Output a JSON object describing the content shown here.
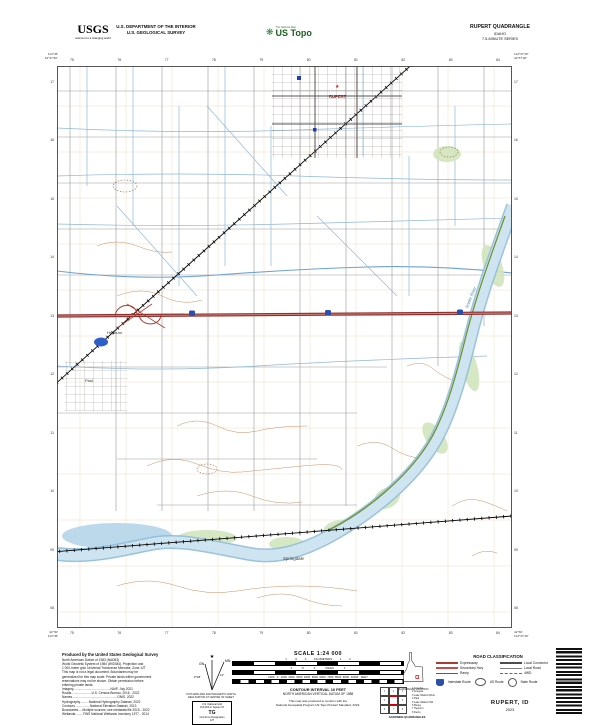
{
  "header": {
    "usgs_logo": "USGS",
    "usgs_tagline": "science for a changing world",
    "dept_line1": "U.S. DEPARTMENT OF THE INTERIOR",
    "dept_line2": "U.S. GEOLOGICAL SURVEY",
    "ustopo_glyph": "❋",
    "ustopo_small": "The National Map",
    "ustopo_name": "US Topo",
    "quad_title": "RUPERT QUADRANGLE",
    "quad_state": "IDAHO",
    "quad_series": "7.5-MINUTE SERIES"
  },
  "collar": {
    "top_ticks": [
      "75",
      "76",
      "77",
      "78",
      "79",
      "80",
      "81",
      "82",
      "83",
      "84"
    ],
    "bottom_ticks": [
      "75",
      "76",
      "77",
      "78",
      "79",
      "80",
      "81",
      "82",
      "83",
      "84"
    ],
    "left_ticks": [
      "17",
      "16",
      "15",
      "14",
      "13",
      "12",
      "11",
      "10",
      "09",
      "08"
    ],
    "right_ticks": [
      "17",
      "16",
      "15",
      "14",
      "13",
      "12",
      "11",
      "10",
      "09",
      "08"
    ],
    "tl_lon": "113°45'",
    "tl_lat": "42°37'30\"",
    "tr_lon": "113°37'30\"",
    "tr_lat": "42°37'30\"",
    "bl_lon": "113°45'",
    "bl_lat": "42°30'",
    "br_lon": "113°37'30\"",
    "br_lat": "42°30'"
  },
  "map_labels": {
    "city": "RUPERT",
    "city_star_icon": "★",
    "heyburn": "Heyburn",
    "paul": "Paul",
    "springdale": "Springdale",
    "river": "Snake River"
  },
  "footer": {
    "produced_by": "Produced by the United States Geological Survey",
    "credits": [
      "North American Datum of 1983 (NAD83)",
      "World Geodetic System of 1984 (WGS84). Projection and",
      "1 000-meter grid: Universal Transverse Mercator, Zone 12T",
      "This map is not a legal document. Boundaries may be",
      "generalized for this map scale. Private lands within government",
      "reservations may not be shown. Obtain permission before",
      "entering private lands.",
      "Imagery..........................................NAIP, July 2021",
      "Roads.......................U.S. Census Bureau, 2016 - 2022",
      "Names...................................................GNIS, 2022",
      "Hydrography..........National Hydrography Dataset, 2022",
      "Contours.................National Elevation Dataset, 2013",
      "Boundaries.....Multiple sources; see metadata file 2015 - 2022",
      "Wetlands.........FWS National Wetlands Inventory 1977 - 2014"
    ],
    "declination": {
      "star": "★",
      "gn_label": "GN",
      "mn_label": "MN",
      "gn_angle": "0°18'",
      "mn_angle": "11°",
      "caption1": "UTM GRID AND 2023 MAGNETIC NORTH",
      "caption2": "DECLINATION AT CENTER OF SHEET"
    },
    "usng": {
      "title": "U.S. National Grid",
      "sub": "100,000-m Square ID",
      "square": "TG",
      "gzd_label": "Grid Zone Designation",
      "gzd": "12T"
    },
    "scale": {
      "title": "SCALE 1:24 000",
      "km_row": "1          .5          0          KILOMETERS          1          2",
      "mi_row": "1            .5             0             MILES             1",
      "ft_row": "1000   0   1000  2000  3000  4000  5000  6000  7000  8000  9000  10000   FEET",
      "contour1": "CONTOUR INTERVAL 10 FEET",
      "contour2": "NORTH AMERICAN VERTICAL DATUM OF 1988",
      "conform1": "This map was produced to conform with the",
      "conform2": "National Geospatial Program US Topo Product Standard, 2023."
    },
    "state": {
      "caption": "QUADRANGLE LOCATION"
    },
    "adjoining": {
      "cells": [
        "1",
        "2",
        "3",
        "4",
        "",
        "5",
        "6",
        "7",
        "8"
      ],
      "names": [
        "1  Scandia",
        "2  Acequia",
        "3  Lake Walcott West",
        "4  Paul",
        "5  Lake Walcott SW",
        "6  Burley",
        "7  Heyburn",
        "8  Declo"
      ],
      "caption": "ADJOINING QUADRANGLES"
    },
    "road_legend": {
      "title": "ROAD CLASSIFICATION",
      "items": [
        "Expressway",
        "Local Connector",
        "Secondary Hwy",
        "Local Road",
        "Ramp",
        "4WD"
      ],
      "shields": [
        "Interstate Route",
        "US Route",
        "State Route"
      ]
    },
    "map_name": "RUPERT, ID",
    "year": "2023"
  },
  "colors": {
    "expressway": "#b03a2e",
    "interstate_shield": "#2b4fad",
    "water": "#bcd9ec",
    "vegetation": "#d2e5bd",
    "contour": "#c89064",
    "canal": "#8fb7d8",
    "ustopo_green": "#1b5e20"
  }
}
